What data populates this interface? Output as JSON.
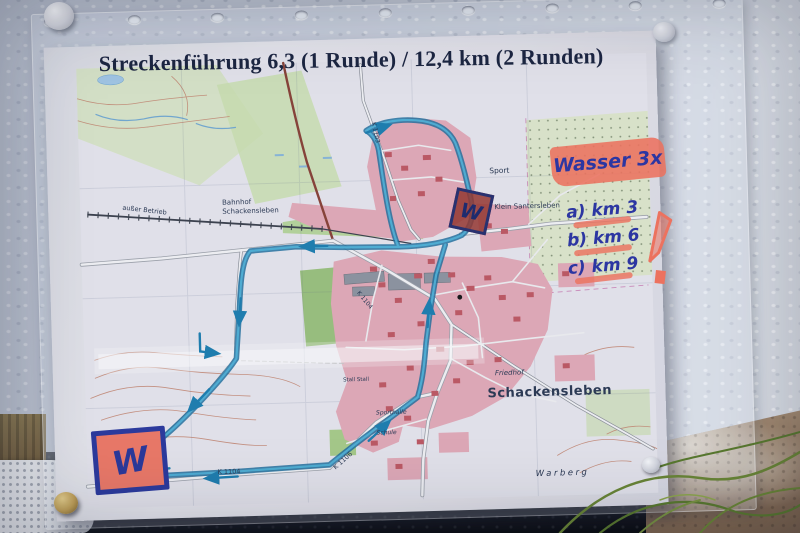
{
  "scene": {
    "title": "Streckenführung 6,3 (1 Runde) / 12,4 km (2 Runden)",
    "handwriting": {
      "wasser": "Wasser 3x",
      "km": [
        "a) km 3",
        "b) km 6",
        "c) km 9"
      ],
      "w_top": "W",
      "w_bottom": "W"
    },
    "map_labels": {
      "bahnhof_line1": "Bahnhof",
      "bahnhof_line2": "Schackensleben",
      "klein_santersleben": "Klein Santersleben",
      "schackensleben": "Schackensleben",
      "friedhof": "Friedhof",
      "sport": "Sport",
      "warberg": "Warberg",
      "ausser_betrieb": "außer Betrieb",
      "sporthalle": "Sporthalle",
      "schule": "Schule",
      "stall": "Stall Stall",
      "road_k1103": "K 1103",
      "road_k1104": "K 1104",
      "road_k1106": "K 1106"
    },
    "colors": {
      "route_blue": "#1e6f9e",
      "route_inner": "#52b2d8",
      "marker_blue": "#2c36a4",
      "highlighter_pink": "#f4745e",
      "builtup_pink": "#e3abb9",
      "forest_green": "#9cc27e",
      "wall_gray": "#ced3de"
    }
  }
}
